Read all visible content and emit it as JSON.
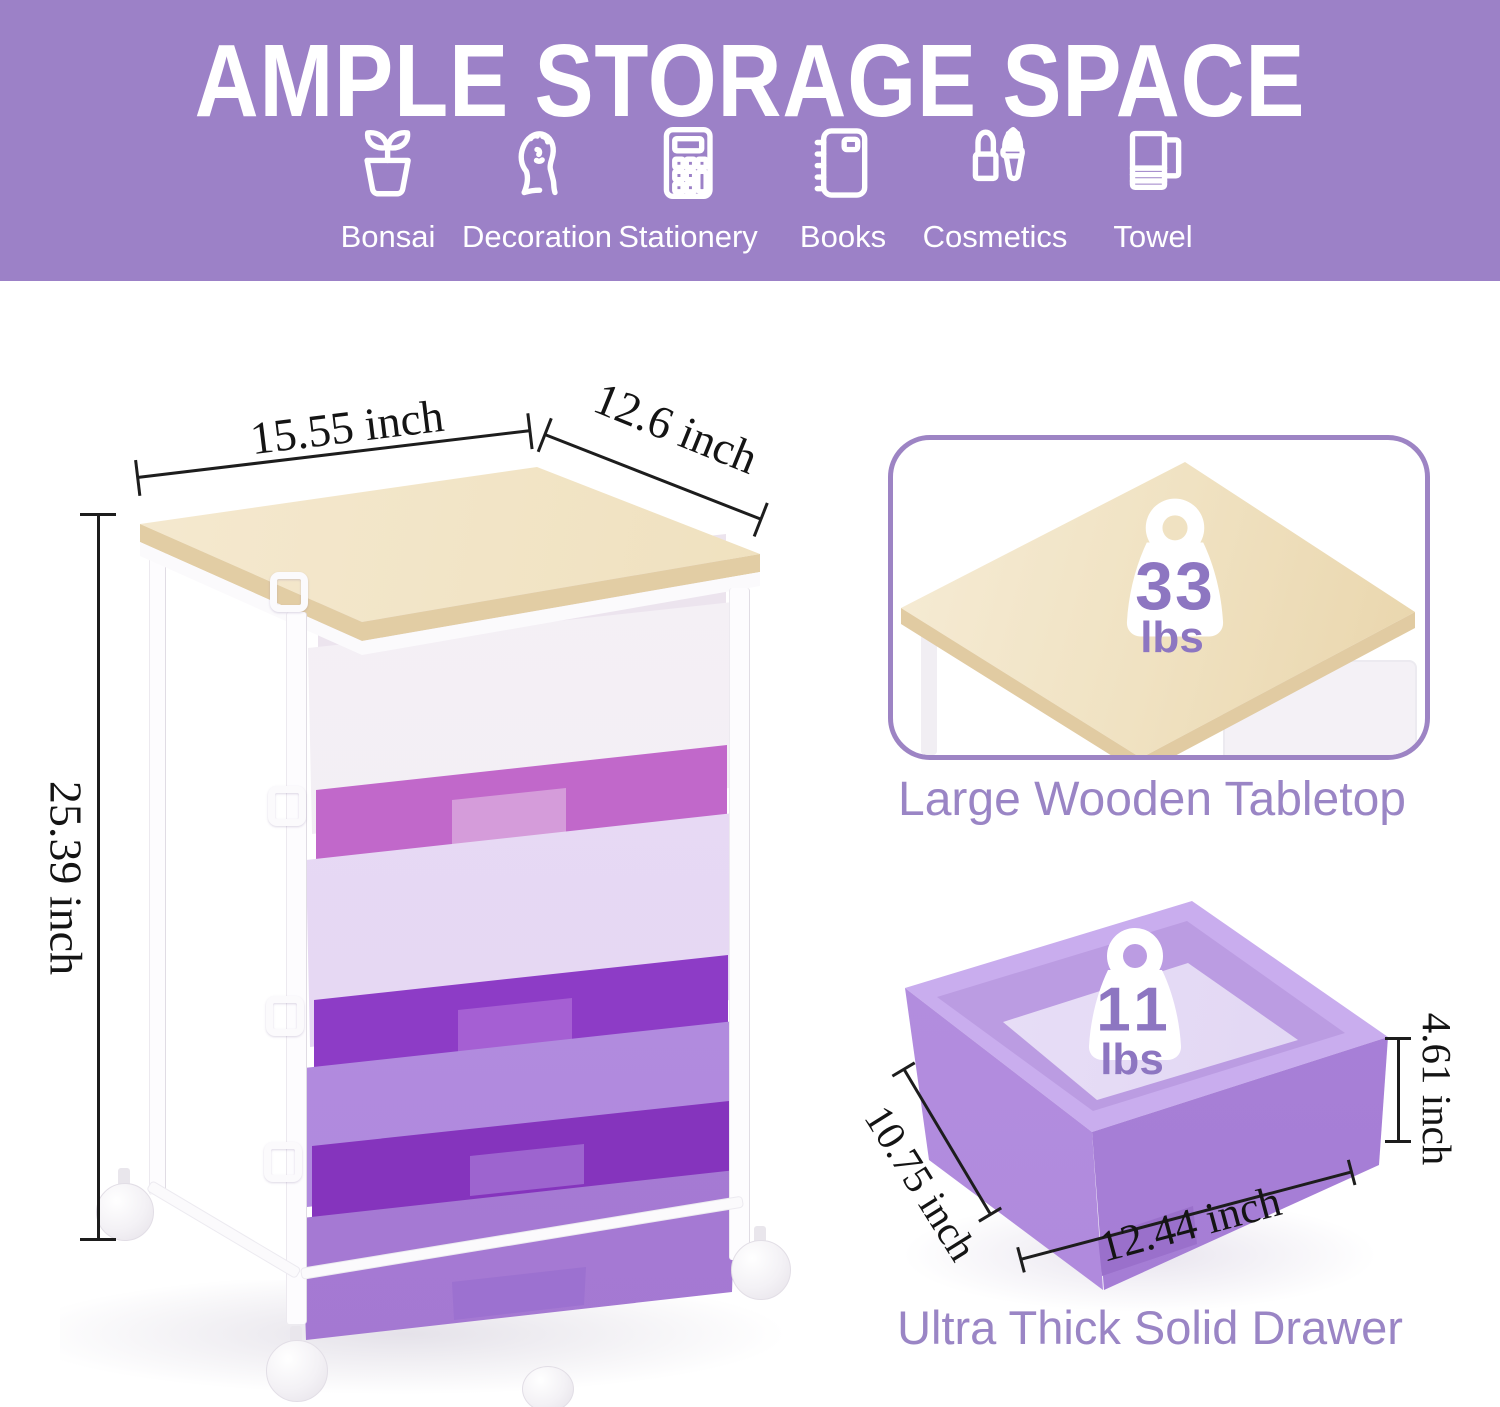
{
  "header": {
    "title": "AMPLE STORAGE SPACE",
    "categories": [
      {
        "label": "Bonsai",
        "icon": "bonsai-icon"
      },
      {
        "label": "Decoration",
        "icon": "bust-icon"
      },
      {
        "label": "Stationery",
        "icon": "calculator-icon"
      },
      {
        "label": "Books",
        "icon": "notebook-icon"
      },
      {
        "label": "Cosmetics",
        "icon": "cosmetics-icon"
      },
      {
        "label": "Towel",
        "icon": "towel-icon"
      }
    ]
  },
  "cart": {
    "width_label": "15.55 inch",
    "depth_label": "12.6 inch",
    "height_label": "25.39 inch"
  },
  "tabletop_panel": {
    "weight_value": "33",
    "weight_unit": "lbs",
    "caption": "Large Wooden Tabletop"
  },
  "drawer_panel": {
    "weight_value": "11",
    "weight_unit": "lbs",
    "caption": "Ultra Thick Solid Drawer",
    "depth_label": "10.75 inch",
    "width_label": "12.44 inch",
    "height_label": "4.61 inch"
  },
  "colors": {
    "header_bg": "#9c81c7",
    "caption_purple": "#9a85c5",
    "card_border": "#9d84c4",
    "weight_number": "#8d76c1",
    "wood": "#efe0bd",
    "drawer1_front": "#f7f3f8",
    "drawer2_front": "#e9dcf5",
    "drawer2_interior": "#c168ca",
    "drawer3_front": "#b590e1",
    "drawer3_interior": "#8d3cc6",
    "drawer4_front": "#aa7fd8",
    "drawer4_interior": "#8534bd",
    "dimension_text": "#141414"
  }
}
